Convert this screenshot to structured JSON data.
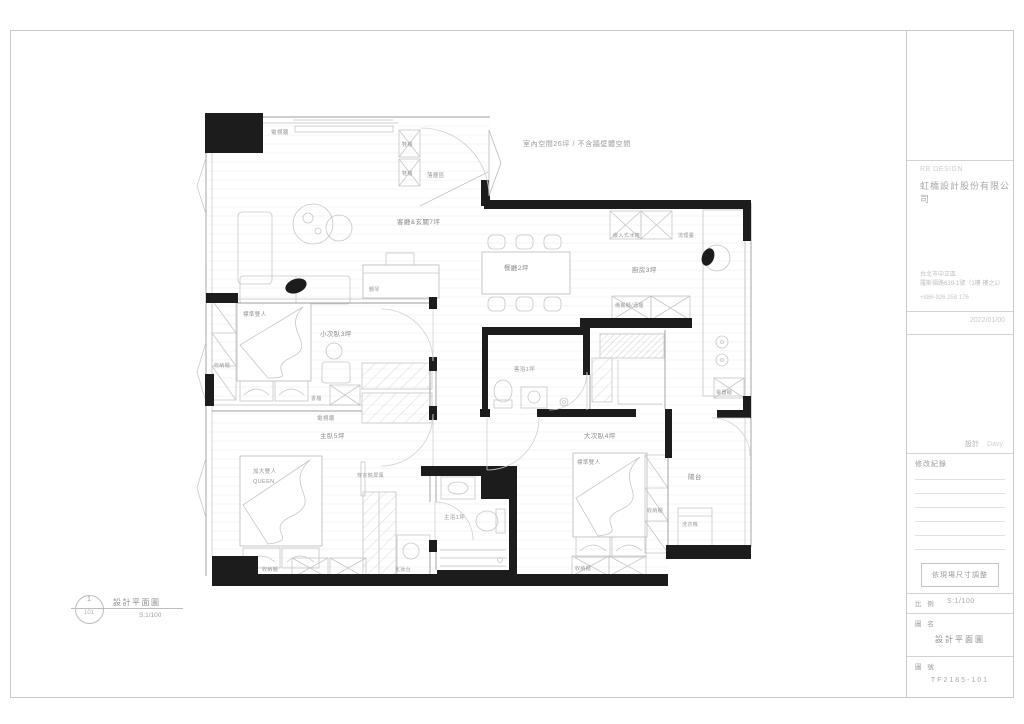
{
  "title_block": {
    "brand_en": "RB DESIGN",
    "company": "虹橋設計股份有限公司",
    "address_line1": "台北市中正區",
    "address_line2": "羅斯福路639-1號（1樓 樓之1）",
    "phone": "+886-926 258 176",
    "date": "2022/01/00",
    "designer_label": "設計",
    "designer_name": "Davy",
    "revision_label": "修改紀錄",
    "note": "依現場尺寸調整",
    "scale_label": "比 例",
    "scale_value": "S:1/100",
    "name_label": "圖 名",
    "drawing_name": "設計平面圖",
    "number_label": "圖 號",
    "drawing_number": "TF2185-101"
  },
  "legend": {
    "index": "1",
    "sheet": "101",
    "title": "設計平面圖",
    "scale": "S:1/100"
  },
  "plan": {
    "area_note": "室內空間26坪 / 不含牆壁體空間",
    "rooms": {
      "living": "客廳&玄關7坪",
      "dining": "餐廳2坪",
      "kitchen": "廚房3坪",
      "entry": "落塵區",
      "small_bedroom": "小次臥3坪",
      "master_bedroom": "主臥5坪",
      "large_bedroom": "大次臥4坪",
      "guest_bath": "客浴1坪",
      "master_bath": "主浴1坪",
      "balcony": "陽台"
    },
    "items": {
      "tv_wall": "電視牆",
      "shoe_cabinet": "鞋櫃",
      "fridge": "嵌入式冰箱",
      "counter": "流理臺",
      "sideboard": "備餐櫃/酒櫃",
      "piano": "鋼琴",
      "std_double": "標準雙人",
      "queen_line1": "加大雙人",
      "queen_line2": "QUEEN",
      "storage": "收納櫃",
      "bookcase": "書櫃",
      "mirror_screen": "穿衣鏡屏風",
      "vanity": "化妝台",
      "washer": "洗衣機",
      "appliance_cabinet": "電器櫃"
    }
  }
}
